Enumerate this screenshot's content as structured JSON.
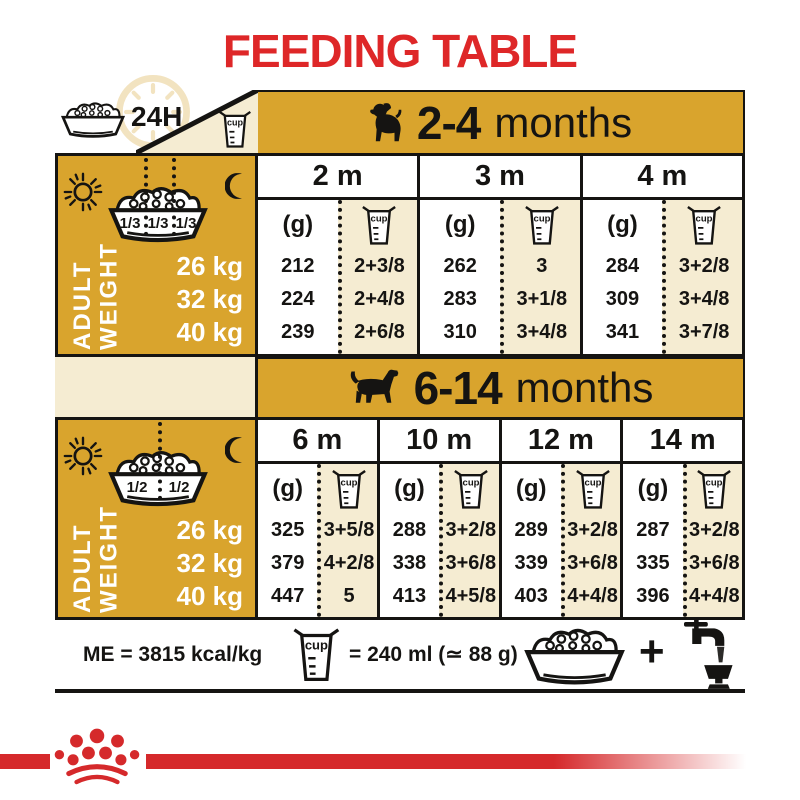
{
  "title": "FEEDING TABLE",
  "colors": {
    "gold": "#D9A42D",
    "cream": "#F5ECD2",
    "title_red": "#DE2728",
    "brand_red": "#D5292B",
    "ink": "#151412"
  },
  "legend": {
    "duration": "24H",
    "cup_label": "cup"
  },
  "sections": [
    {
      "age_range": "2-4",
      "age_suffix": "months",
      "bowl_fractions": [
        "1/3",
        "1/3",
        "1/3"
      ],
      "row_header": {
        "line1": "ADULT",
        "line2": "WEIGHT"
      },
      "weights": [
        "26 kg",
        "32 kg",
        "40 kg"
      ],
      "unit_g": "(g)",
      "months": [
        {
          "label": "2 m",
          "grams": [
            "212",
            "224",
            "239"
          ],
          "cups": [
            "2+3/8",
            "2+4/8",
            "2+6/8"
          ]
        },
        {
          "label": "3 m",
          "grams": [
            "262",
            "283",
            "310"
          ],
          "cups": [
            "3",
            "3+1/8",
            "3+4/8"
          ]
        },
        {
          "label": "4 m",
          "grams": [
            "284",
            "309",
            "341"
          ],
          "cups": [
            "3+2/8",
            "3+4/8",
            "3+7/8"
          ]
        }
      ]
    },
    {
      "age_range": "6-14",
      "age_suffix": "months",
      "bowl_fractions": [
        "1/2",
        "1/2"
      ],
      "row_header": {
        "line1": "ADULT",
        "line2": "WEIGHT"
      },
      "weights": [
        "26 kg",
        "32 kg",
        "40 kg"
      ],
      "unit_g": "(g)",
      "months": [
        {
          "label": "6 m",
          "grams": [
            "325",
            "379",
            "447"
          ],
          "cups": [
            "3+5/8",
            "4+2/8",
            "5"
          ]
        },
        {
          "label": "10 m",
          "grams": [
            "288",
            "338",
            "413"
          ],
          "cups": [
            "3+2/8",
            "3+6/8",
            "4+5/8"
          ]
        },
        {
          "label": "12 m",
          "grams": [
            "289",
            "339",
            "403"
          ],
          "cups": [
            "3+2/8",
            "3+6/8",
            "4+4/8"
          ]
        },
        {
          "label": "14 m",
          "grams": [
            "287",
            "335",
            "396"
          ],
          "cups": [
            "3+2/8",
            "3+6/8",
            "4+4/8"
          ]
        }
      ]
    }
  ],
  "footer": {
    "me": "ME = 3815 kcal/kg",
    "cup_equiv": "= 240 ml (≃ 88 g)",
    "plus": "+"
  }
}
